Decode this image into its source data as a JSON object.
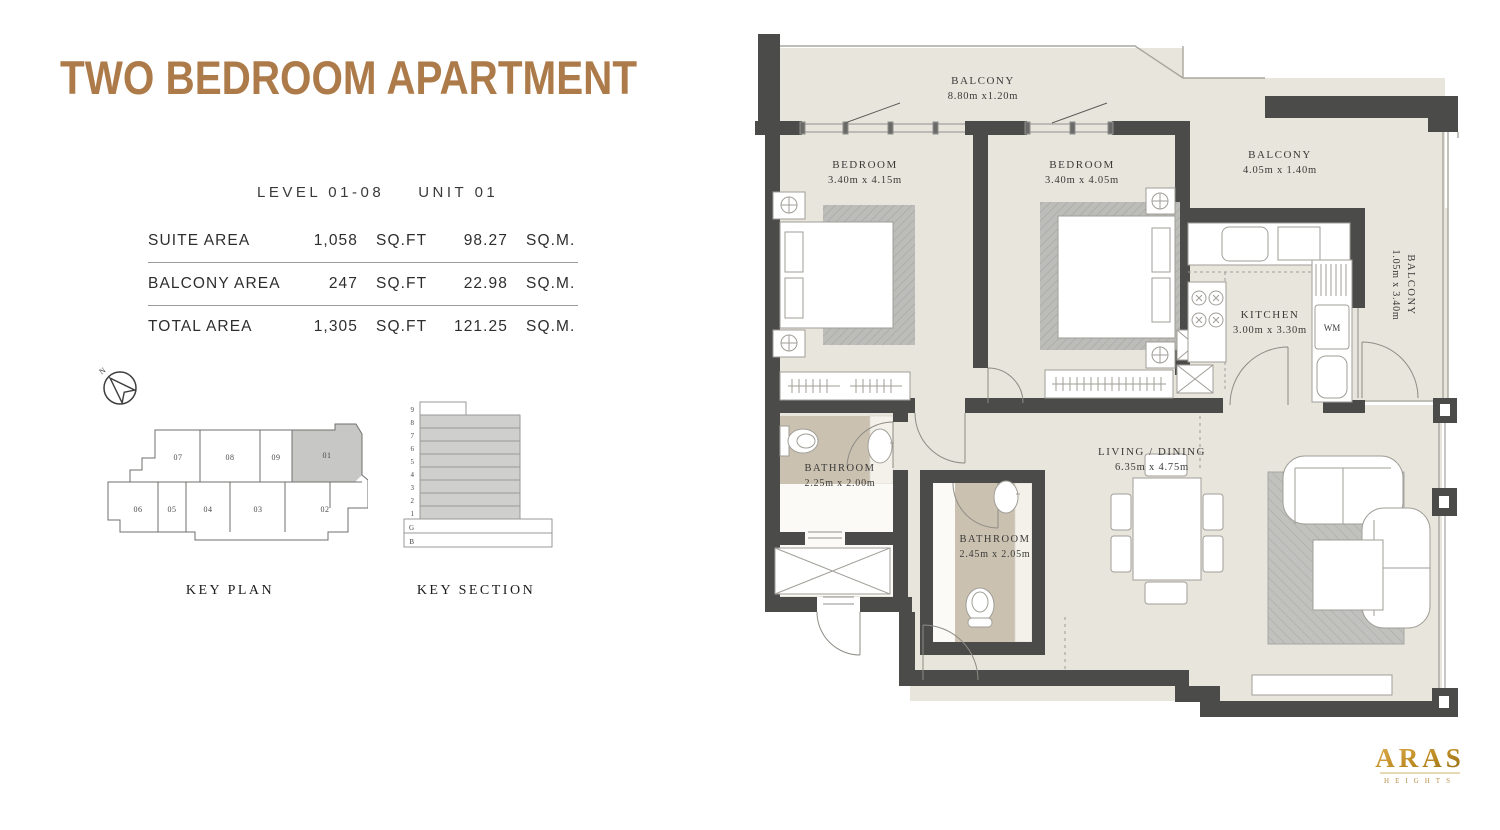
{
  "page": {
    "title": "TWO BEDROOM APARTMENT",
    "level_label": "LEVEL 01-08",
    "unit_label": "UNIT 01"
  },
  "area_table": {
    "rows": [
      {
        "label": "SUITE AREA",
        "sqft": "1,058",
        "sqft_unit": "SQ.FT",
        "sqm": "98.27",
        "sqm_unit": "SQ.M."
      },
      {
        "label": "BALCONY AREA",
        "sqft": "247",
        "sqft_unit": "SQ.FT",
        "sqm": "22.98",
        "sqm_unit": "SQ.M."
      },
      {
        "label": "TOTAL AREA",
        "sqft": "1,305",
        "sqft_unit": "SQ.FT",
        "sqm": "121.25",
        "sqm_unit": "SQ.M."
      }
    ]
  },
  "compass": {
    "north_label": "N"
  },
  "key_plan": {
    "caption": "KEY PLAN",
    "highlighted_unit": "01",
    "units_top": [
      "07",
      "08",
      "09",
      "01"
    ],
    "units_bottom": [
      "06",
      "05",
      "04",
      "03",
      "02"
    ]
  },
  "key_section": {
    "caption": "KEY SECTION",
    "levels": [
      "9",
      "8",
      "7",
      "6",
      "5",
      "4",
      "3",
      "2",
      "1",
      "G",
      "B"
    ],
    "highlighted_levels": "1-8"
  },
  "floor_plan": {
    "wm_label": "WM",
    "rooms": [
      {
        "name": "BALCONY",
        "dims": "8.80m x1.20m"
      },
      {
        "name": "BEDROOM",
        "dims": "3.40m x 4.15m"
      },
      {
        "name": "BEDROOM",
        "dims": "3.40m x 4.05m"
      },
      {
        "name": "BALCONY",
        "dims": "4.05m x 1.40m"
      },
      {
        "name": "BALCONY",
        "dims": "1.05m x 3.40m"
      },
      {
        "name": "KITCHEN",
        "dims": "3.00m x 3.30m"
      },
      {
        "name": "BATHROOM",
        "dims": "2.25m x 2.00m"
      },
      {
        "name": "BATHROOM",
        "dims": "2.45m x 2.05m"
      },
      {
        "name": "LIVING / DINING",
        "dims": "6.35m x 4.75m"
      }
    ]
  },
  "brand": {
    "name": "ARAS",
    "sub": "HEIGHTS"
  },
  "colors": {
    "title_brown": "#ad7b4a",
    "wall_dark": "#4b4b49",
    "floor_beige": "#e8e5dc",
    "bath_taupe": "#cbc1b1",
    "logo_gold": "#b8860b",
    "highlight_gray": "#c7c7c5"
  }
}
